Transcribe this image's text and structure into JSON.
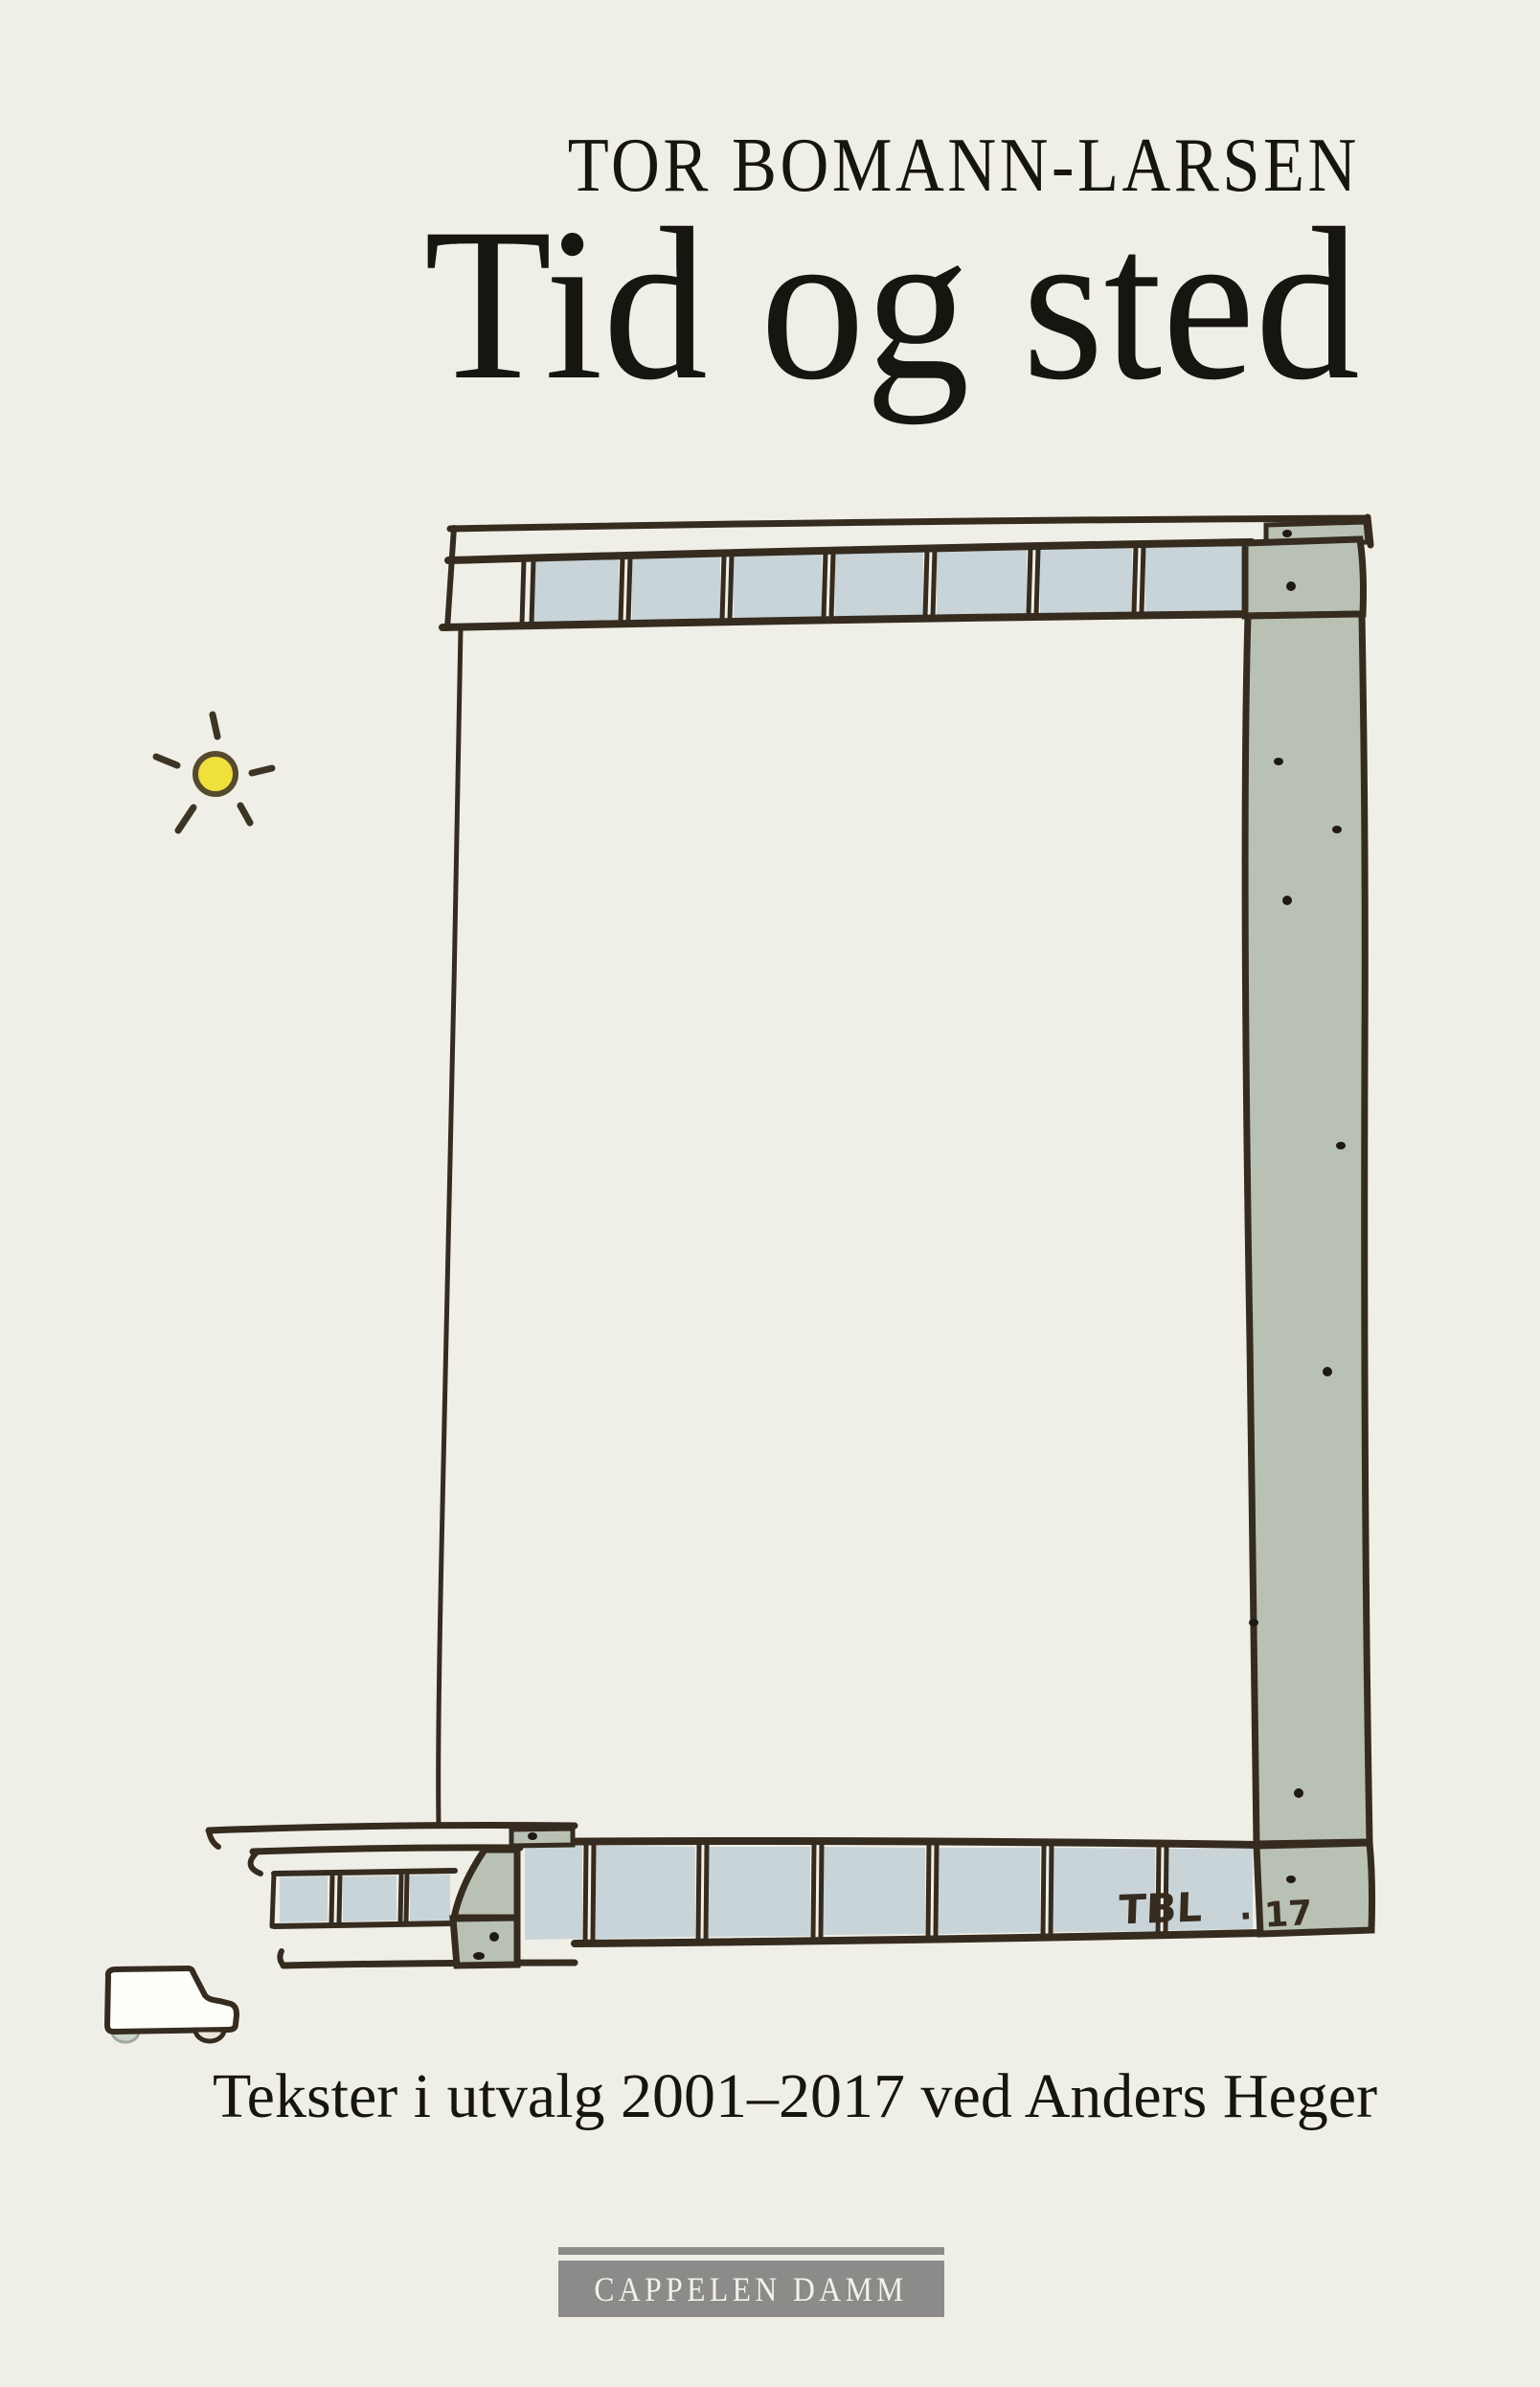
{
  "cover": {
    "author": "TOR BOMANN-LARSEN",
    "title": "Tid og sted",
    "subtitle": "Tekster i utvalg 2001–2017 ved Anders Heger",
    "publisher": "CAPPELEN DAMM",
    "signature": "TBL",
    "signature_year": "· 17"
  },
  "colors": {
    "background": "#f0efe7",
    "ink": "#352b1f",
    "text_ink": "#17150f",
    "block_blue": "#c9d4d8",
    "stone_sage": "#b9c1b4",
    "stone_sage_dark": "#aab4a8",
    "sun_yellow": "#f0e03c",
    "sun_outline": "#564a2c",
    "publisher_gray": "#8d8b89",
    "publisher_text": "#f2f1ec"
  }
}
